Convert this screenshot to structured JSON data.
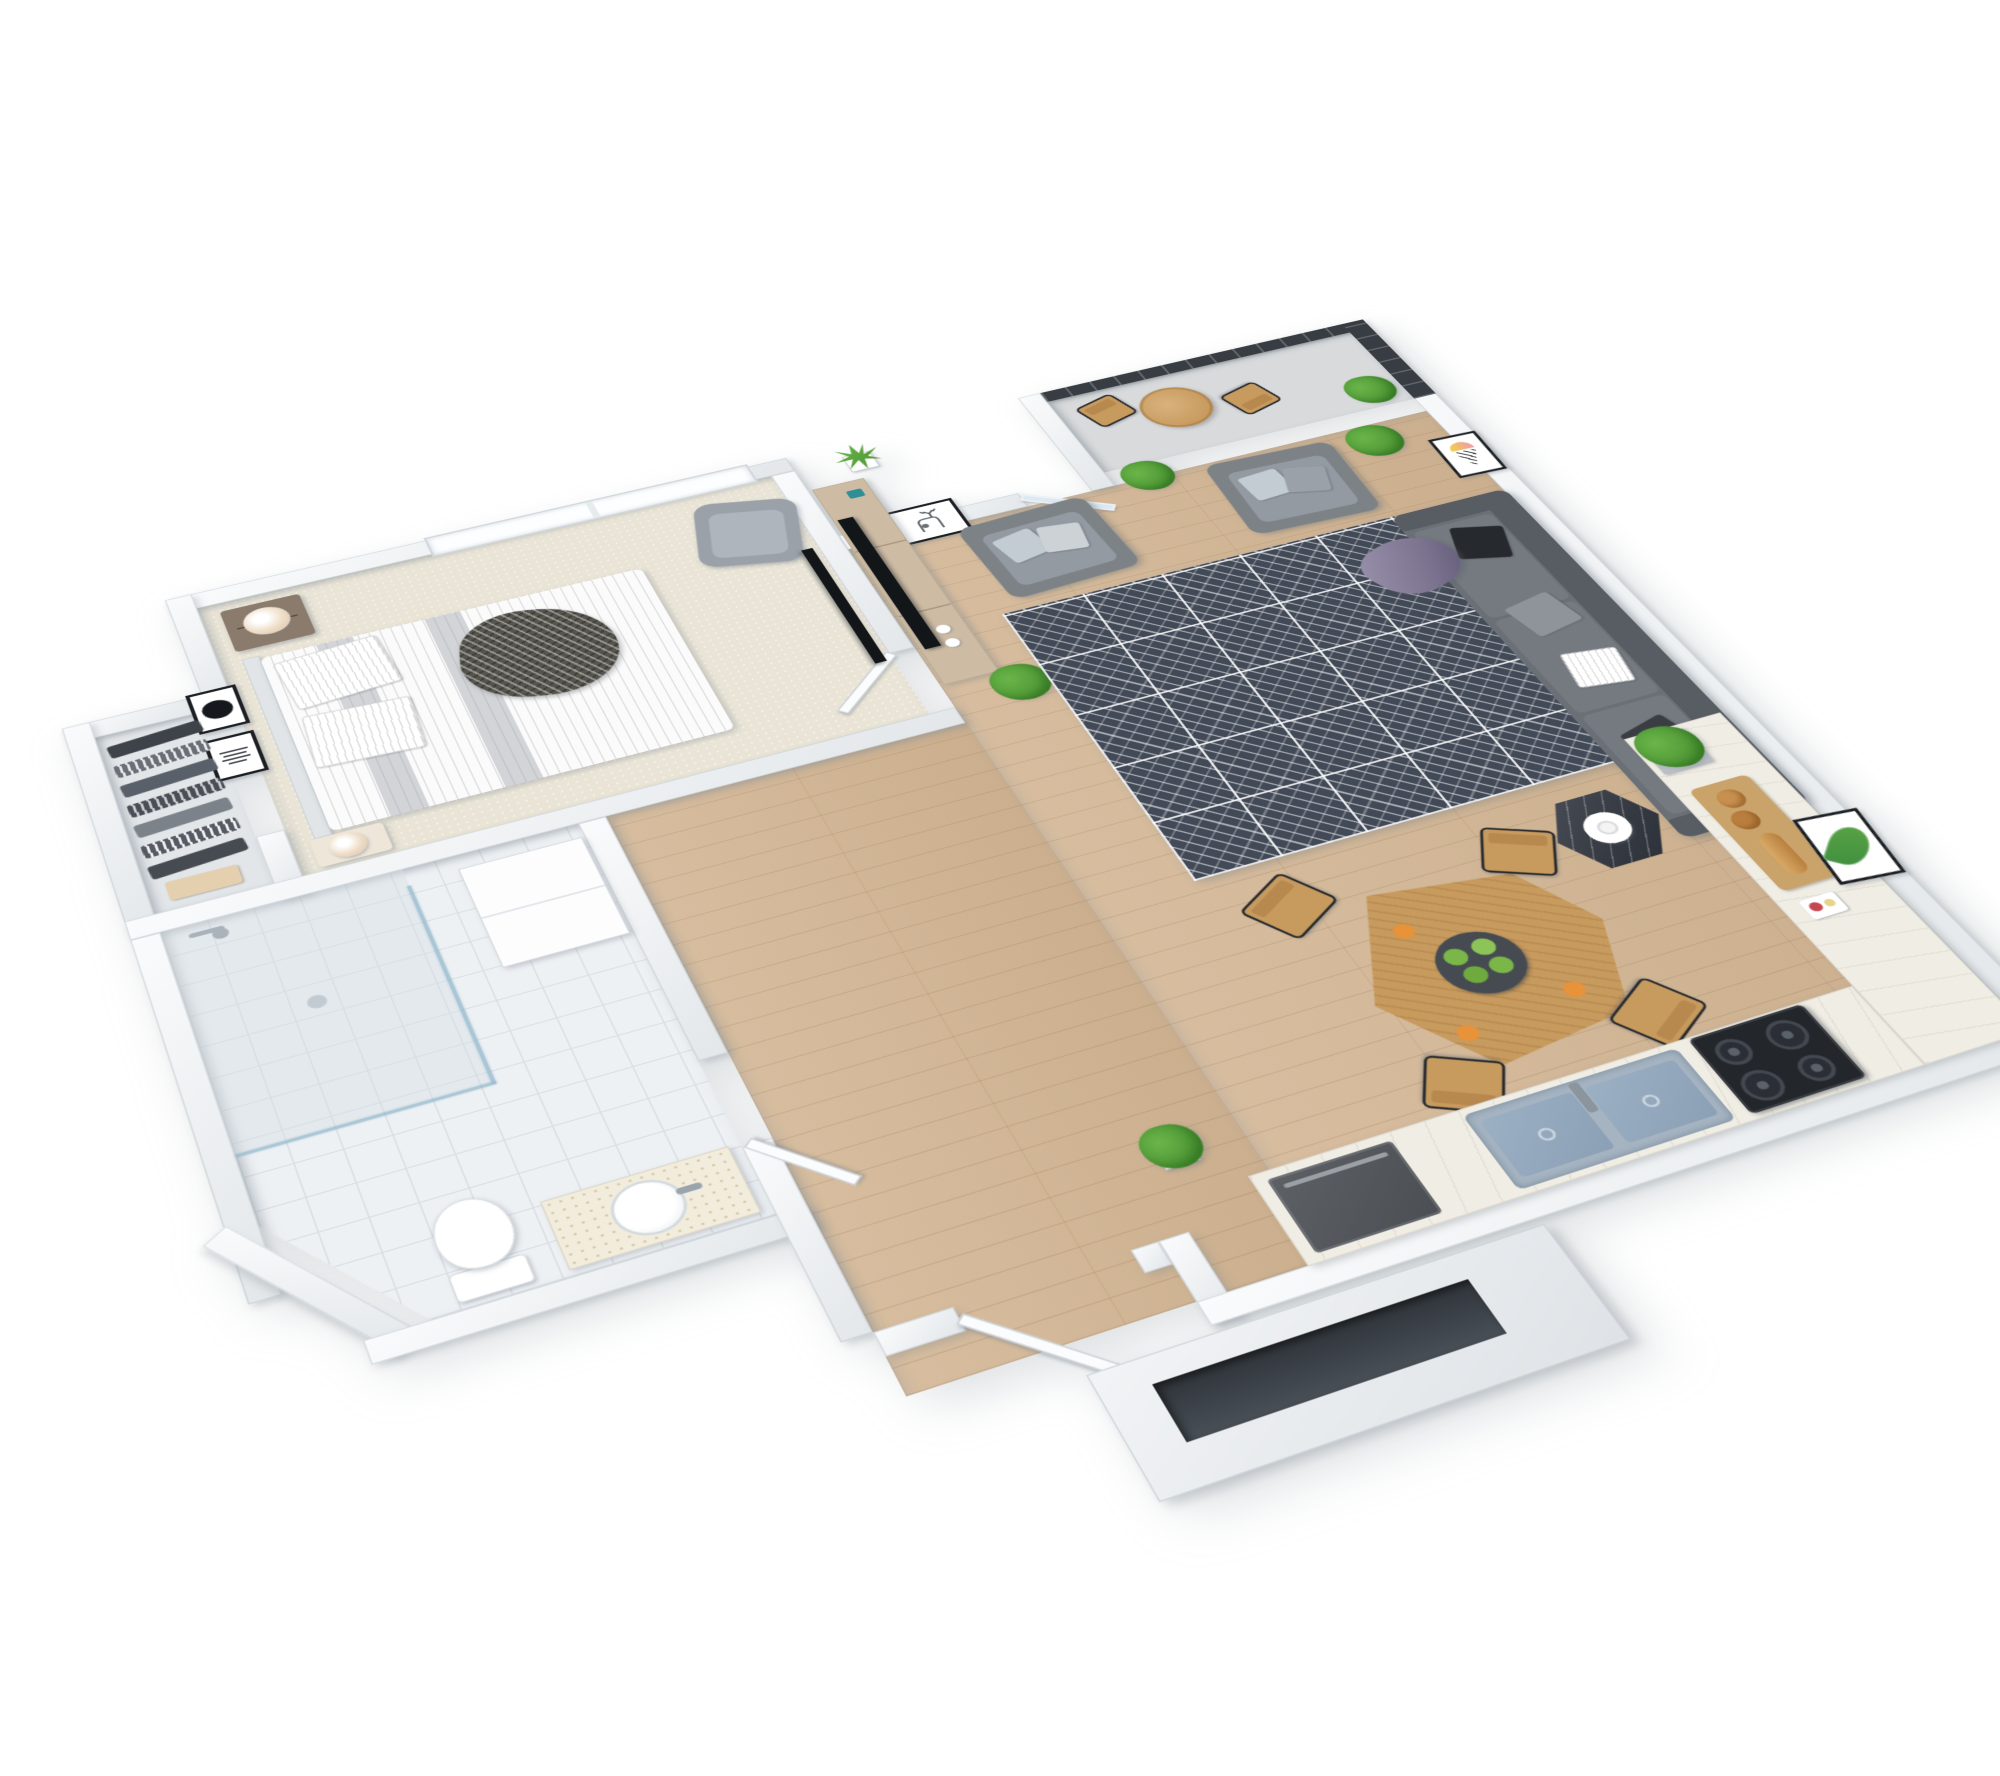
{
  "scene": {
    "title": "3D isometric floor plan render of a one-bedroom apartment",
    "view": "rotated top-down axonometric",
    "background": "#ffffff"
  },
  "palette": {
    "background": "#ffffff",
    "wallTop": "#f7f9fa",
    "wallEdge": "#c9cfd5",
    "carpet": "#e9e4d6",
    "wood": "#d3b694",
    "tile": "#eef1f4",
    "tileLine": "#d8dee3",
    "concrete": "#d8dadc",
    "rug": "#424a57",
    "sofa": "#6b7076",
    "sofaDark": "#585d63",
    "chair": "#7d8287",
    "chairInner": "#939aa2",
    "pillowLight": "#c3ccd3",
    "pillowDark": "#26292d",
    "purple": "#7d7490",
    "woodFurn": "#8b7b6c",
    "woodTable": "#c79a5e",
    "marble": "#363a42",
    "steel": "#a6b4c2",
    "steelBasin": "#8ba0b5",
    "stove": "#23262b",
    "plant": "#4c9433",
    "plantLight": "#6ab54a",
    "lamp": "#eedcc6",
    "screen": "#383d43",
    "tv": "#131619",
    "frame": "#1c1f23",
    "orange": "#e8923a",
    "lime": "#7ab648",
    "bread": "#c8904f",
    "glass": "#dce9f2",
    "teal": "#2e8f96",
    "consoleWood": "#cdbba4",
    "headboard": "#e1e5e8"
  },
  "rooms": {
    "bedroom": {
      "name": "Bedroom",
      "floor": "beige carpet",
      "items": [
        "double bed with gray striped duvet",
        "herringbone throw blanket",
        "striped pillows",
        "upholstered headboard",
        "dark wood nightstand with beige table lamp",
        "second nightstand with lamp",
        "gray wingback armchair",
        "wall-mounted TV",
        "framed moon artwork",
        "framed typography artwork",
        "large double window"
      ]
    },
    "closet": {
      "name": "Walk-in closet",
      "floor": "light gray",
      "items": [
        "rail of hanging clothes in grays and stripes",
        "storage box"
      ]
    },
    "bathroom": {
      "name": "Bathroom",
      "floor": "white tile",
      "items": [
        "walk-in shower with glass screen",
        "shower rail and hand shower",
        "toilet",
        "counter with round basin and faucet",
        "white storage cabinet",
        "door to hall"
      ]
    },
    "hall": {
      "name": "Entry hall",
      "floor": "light wood",
      "items": [
        "entry door standing open",
        "potted plant by the door"
      ]
    },
    "living": {
      "name": "Living room",
      "floor": "light wood",
      "items": [
        "gray fabric sofa with black, gray and striped pillows",
        "purple throw",
        "two gray armchairs with light blue pillows",
        "dark geometric area rug",
        "light wood TV console with flat-screen TV",
        "teal box and white jar decor",
        "black marble hexagonal side table with white ring decor",
        "framed deer artwork",
        "framed ice cream artwork",
        "framed monstera artwork",
        "potted plants",
        "glass door to balcony"
      ]
    },
    "dining": {
      "name": "Dining area",
      "floor": "light wood",
      "items": [
        "angular light wood dining table",
        "four wood chairs with black metal frames",
        "dark plate with limes",
        "loose oranges"
      ]
    },
    "kitchen": {
      "name": "Kitchen",
      "floor": "light wood",
      "items": [
        "L-shaped white counter",
        "double stainless sink with faucet",
        "built-in dishwasher",
        "black gas stove with four burners",
        "cutting board with bread and pretzels",
        "snack plates",
        "potted plant"
      ]
    },
    "balcony": {
      "name": "Balcony",
      "floor": "concrete",
      "items": [
        "round wood bistro table",
        "two metal-and-wood chairs",
        "dark louvered privacy screen",
        "potted plant"
      ]
    }
  },
  "exterior": {
    "name": "Entry porch",
    "items": [
      "white porch volume with dark recessed niche"
    ]
  }
}
